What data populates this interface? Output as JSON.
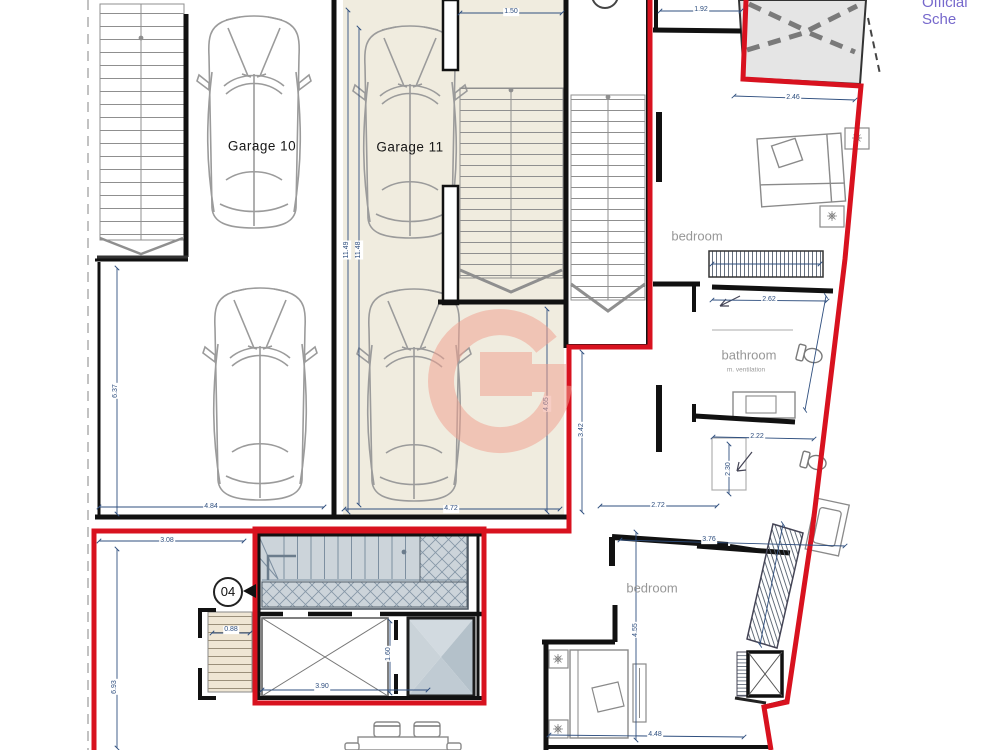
{
  "header": {
    "official_label": "Official Sche"
  },
  "labels": {
    "garage10": "Garage 10",
    "garage11": "Garage 11",
    "bedroom_top": "bedroom",
    "bathroom": "bathroom",
    "bathroom_note": "m. ventilation",
    "bedroom_bottom": "bedroom",
    "unit_badge": "04"
  },
  "dimensions": {
    "w1_50": "1.50",
    "w1_92": "1.92",
    "w2_46": "2.46",
    "w11_49": "11.49",
    "w11_48": "11.48",
    "w6_37": "6.37",
    "w4_84": "4.84",
    "w4_72": "4.72",
    "w4_65": "4.65",
    "w3_42": "3.42",
    "w2_72": "2.72",
    "w2_62": "2.62",
    "w2_22": "2.22",
    "w2_30": "2.30",
    "w3_76": "3.76",
    "w4_55": "4.55",
    "w4_48": "4.48",
    "w3_08": "3.08",
    "w6_93": "6.93",
    "w0_88": "0.88",
    "w3_90": "3.90",
    "w1_60": "1.60"
  },
  "colors": {
    "boundary_red": "#d8121f",
    "dimension_blue": "#2f4f7f",
    "garage_floor_beige": "#f0ecdf",
    "stair_core_grey": "#ccd4da",
    "watermark_salmon": "#f0a190",
    "roof_grey": "#e5e5e5",
    "wall_black": "#111111",
    "label_grey": "#979797",
    "official_text_purple": "#7668cc"
  }
}
